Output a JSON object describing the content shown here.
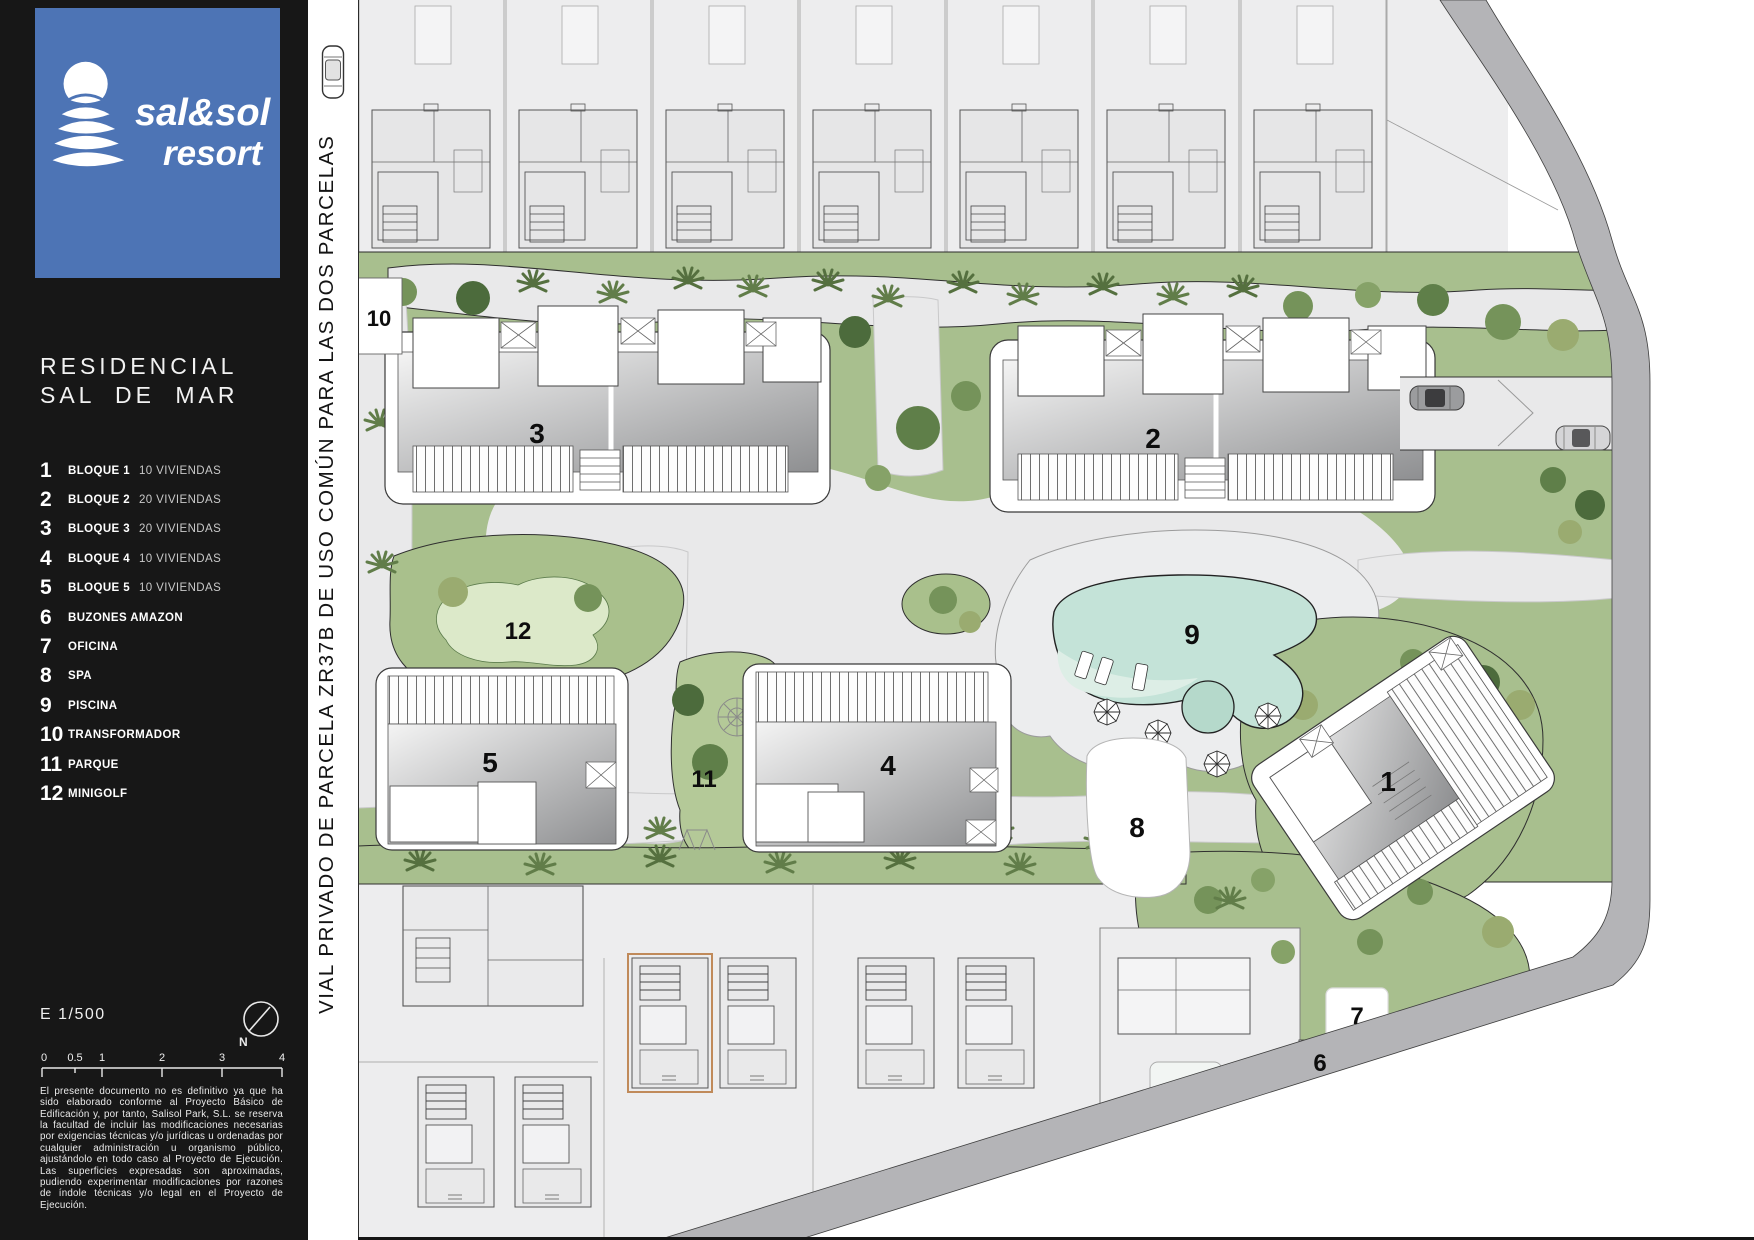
{
  "sidebar": {
    "logo": {
      "line1": "sal&sol",
      "line2": "resort"
    },
    "title_line1": "RESIDENCIAL",
    "title_line2": "SAL DE MAR",
    "legend": [
      {
        "num": "1",
        "label": "BLOQUE 1",
        "value": "10 VIVIENDAS"
      },
      {
        "num": "2",
        "label": "BLOQUE 2",
        "value": "20 VIVIENDAS"
      },
      {
        "num": "3",
        "label": "BLOQUE 3",
        "value": "20 VIVIENDAS"
      },
      {
        "num": "4",
        "label": "BLOQUE 4",
        "value": "10 VIVIENDAS"
      },
      {
        "num": "5",
        "label": "BLOQUE 5",
        "value": "10 VIVIENDAS"
      },
      {
        "num": "6",
        "label": "BUZONES AMAZON",
        "value": ""
      },
      {
        "num": "7",
        "label": "OFICINA",
        "value": ""
      },
      {
        "num": "8",
        "label": "SPA",
        "value": ""
      },
      {
        "num": "9",
        "label": "PISCINA",
        "value": ""
      },
      {
        "num": "10",
        "label": "TRANSFORMADOR",
        "value": ""
      },
      {
        "num": "11",
        "label": "PARQUE",
        "value": ""
      },
      {
        "num": "12",
        "label": "MINIGOLF",
        "value": ""
      }
    ],
    "scale_label": "E 1/500",
    "north_label": "N",
    "scalebar_ticks": [
      "0",
      "0.5",
      "1",
      "2",
      "3",
      "4"
    ],
    "disclaimer": "El presente documento no es definitivo ya que ha sido elaborado conforme al Proyecto Básico de Edificación y, por tanto, Salisol Park, S.L. se reserva la facultad de incluir las modificaciones necesarias por exigencias técnicas y/o jurídicas u ordenadas por cualquier administración u organismo público, ajustándolo en todo caso al Proyecto de Ejecución. Las superficies expresadas son aproximadas, pudiendo experimentar modificaciones por razones de índole técnicas y/o legal en el Proyecto de Ejecución."
  },
  "street_label": "VIAL PRIVADO DE PARCELA ZR37B DE USO COMÚN PARA LAS DOS PARCELAS",
  "plan": {
    "labels": [
      "1",
      "2",
      "3",
      "4",
      "5",
      "6",
      "7",
      "8",
      "9",
      "10",
      "11",
      "12"
    ]
  },
  "colors": {
    "accent_blue": "#4d74b5",
    "grass_green": "#a8bf8e",
    "pool_teal": "#c4e3d8",
    "sidewalk_gray": "#b4b4b7",
    "plot_gray": "#ededee",
    "highlight_orange": "#c08a5a"
  }
}
